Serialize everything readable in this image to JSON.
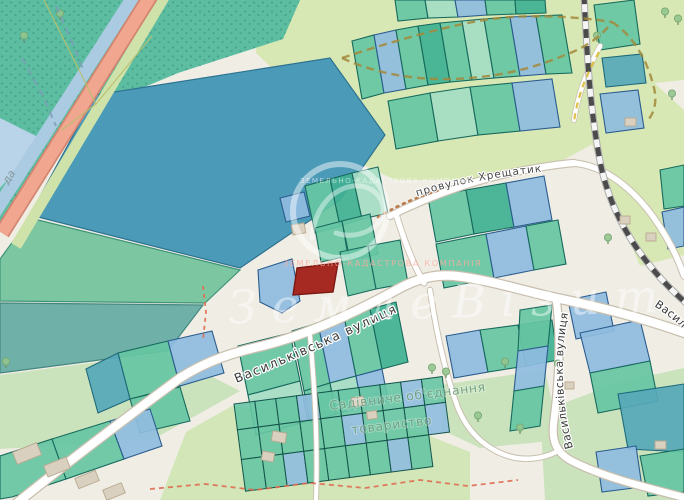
{
  "map": {
    "width": 684,
    "height": 500,
    "palette": {
      "base": "#f0ede5",
      "green_light": "#d8e8b4",
      "green_grass": "#cbe3bd",
      "green_garden": "#d2e6b8",
      "scrub": "#5dbda1",
      "scrub_dot": "#3e9a83",
      "water": "#aacbe1",
      "water_light": "#b9d4e9",
      "verge": "#cfe2a9",
      "highway": "#f1a690",
      "highway_casing": "#d28570",
      "field_blue": "#4a9ab8",
      "field_green": "#7cc6a2",
      "field_gray": "#6fb0a8",
      "parcel_teal": "#66c5a3",
      "parcel_teal_dark": "#3fb192",
      "parcel_teal_pale": "#a4dcc3",
      "parcel_blue": "#8fbcdf",
      "parcel_blue_steel": "#5e9fca",
      "parcel_blue_teal": "#57a8ba",
      "stroke_teal": "#17695c",
      "stroke_blue": "#2b5c8e",
      "stroke_blue_teal": "#1f6a7a",
      "target_red": "#a62a21",
      "target_red_stroke": "#7c1a14",
      "road_casing": "#c8bfae",
      "road_fill": "#ffffff",
      "rail_dark": "#4b4b4b",
      "building": "#d9d0c0",
      "building_stroke": "#b9a98f"
    },
    "labels": {
      "street_main": "Васильківська вулиця",
      "street_south": "Васильківська вулиця",
      "street_east_partial": "Васил",
      "lane": "провулок Хрещатик",
      "garden_assoc_line1": "Садівниче об'єднання",
      "garden_assoc_line2": "товариство",
      "water_partial": "да"
    },
    "watermark": {
      "script": "ЗемлеВізит",
      "caps": "ЗЕМЕЛЬНО-КАДАСТРОВА КОМПАНІЯ",
      "ring": {
        "cx": 340,
        "cy": 211,
        "r": 47,
        "w": 6
      },
      "swirl": "M 312,238 C 316,186 366,172 381,200 C 392,222 362,242 336,233",
      "script_x": 228,
      "script_y": 318,
      "script_len": 430,
      "caps_mid": {
        "x": 283,
        "y": 266
      },
      "caps_top": {
        "x": 300,
        "y": 183
      }
    },
    "areas": [
      {
        "p": "258,0 684,0 684,80 560,93 430,109 330,123 256,53",
        "f": "green_light"
      },
      {
        "p": "572,80 640,70 684,110 684,255 640,266 600,170",
        "f": "green_light"
      },
      {
        "p": "310,103 555,24 618,19 658,90 600,140 545,170 470,180 395,180 333,150",
        "f": "green_light"
      },
      {
        "p": "0,0 148,0 4,232 0,232",
        "f": "scrub",
        "pat": true
      },
      {
        "p": "62,0 300,0 283,39 178,73 92,109 40,79",
        "f": "scrub",
        "pat": true
      },
      {
        "p": "0,118 44,140 0,188",
        "f": "water_light"
      },
      {
        "p": "95,95 330,58 385,135 340,200 240,268 30,215",
        "f": "field_blue",
        "s": "#2e7290"
      },
      {
        "p": "30,218 240,270 205,303 0,301 0,259",
        "f": "field_green",
        "s": "#3f9478"
      },
      {
        "p": "0,303 203,305 168,351 0,373",
        "f": "field_gray",
        "s": "#43897f"
      },
      {
        "p": "0,375 166,353 240,391 150,441 0,449",
        "f": "green_grass"
      },
      {
        "p": "440,385 545,370 560,440 480,448 442,430",
        "f": "green_grass"
      },
      {
        "p": "540,412 620,382 684,368 684,500 545,500",
        "f": "green_grass"
      },
      {
        "p": "160,500 186,432 232,406 420,432 470,452 470,500",
        "f": "green_garden"
      }
    ],
    "bands": [
      {
        "d": "M 166,-6 L 16,246",
        "s": "#cfe2a9",
        "w": 11
      },
      {
        "d": "M 135,-6 L -14,226",
        "s": "#aacbe1",
        "w": 13
      },
      {
        "d": "M 153,-8 L 2,233",
        "s": "#d28570",
        "w": 16
      },
      {
        "d": "M 153,-8 L 2,233",
        "s": "#f1a690",
        "w": 12.5
      }
    ],
    "railway": {
      "d": "M 584,-5 C 587,55 590,112 601,166 C 613,222 646,268 686,303"
    },
    "roads": [
      {
        "d": "M 12,507 C 60,468 130,415 180,378 C 208,360 235,352 262,346 C 310,334 356,312 398,289 C 418,278 436,274 456,276 C 490,280 520,290 556,298 C 600,307 636,316 688,334",
        "cw": 11,
        "fw": 8.5
      },
      {
        "d": "M 556,298 C 562,340 558,390 554,420 C 551,440 556,452 570,460 C 600,476 640,486 690,499",
        "cw": 9.5,
        "fw": 7
      },
      {
        "d": "M 390,216 C 430,196 470,182 510,173 C 540,167 560,164 574,163",
        "cw": 8.5,
        "fw": 6.2
      },
      {
        "d": "M 574,163 C 606,166 634,190 654,218 C 668,238 678,258 684,276",
        "cw": 7.5,
        "fw": 5.5
      },
      {
        "d": "M 396,214 C 404,240 412,262 424,283",
        "cw": 7,
        "fw": 5.2
      },
      {
        "d": "M 310,336 C 315,390 318,445 316,500",
        "cw": 6,
        "fw": 4.2
      },
      {
        "d": "M 430,290 C 436,330 444,370 458,408 C 468,432 484,448 508,456 C 524,461 542,459 556,452",
        "cw": 6.5,
        "fw": 4.6
      },
      {
        "d": "M 600,46 C 588,68 578,94 574,120",
        "cw": 6,
        "fw": 4.5
      }
    ],
    "parcels": [
      {
        "p": "395,0 425,0 428,18 398,21",
        "c": "t"
      },
      {
        "p": "425,0 455,0 458,17 428,18",
        "c": "tl"
      },
      {
        "p": "455,0 485,0 487,15 458,17",
        "c": "b"
      },
      {
        "p": "485,0 515,0 516,14 487,15",
        "c": "t"
      },
      {
        "p": "515,0 545,0 546,13 516,14",
        "c": "td"
      },
      {
        "p": "352,41 374,35 384,93 362,99",
        "c": "t"
      },
      {
        "p": "374,35 396,30 406,89 384,93",
        "c": "b"
      },
      {
        "p": "396,30 418,26 428,85 406,89",
        "c": "t"
      },
      {
        "p": "418,26 440,23 450,82 428,85",
        "c": "td"
      },
      {
        "p": "440,23 462,21 472,80 450,82",
        "c": "t"
      },
      {
        "p": "462,21 484,19 494,78 472,80",
        "c": "tl"
      },
      {
        "p": "484,19 510,17 520,76 494,78",
        "c": "t"
      },
      {
        "p": "510,17 536,16 546,74 520,76",
        "c": "b"
      },
      {
        "p": "536,16 562,15 572,73 546,74",
        "c": "t"
      },
      {
        "p": "388,101 430,93 438,141 396,149",
        "c": "t"
      },
      {
        "p": "430,93 470,87 478,135 438,141",
        "c": "tl"
      },
      {
        "p": "470,87 512,83 520,131 478,135",
        "c": "t"
      },
      {
        "p": "512,83 552,79 560,127 520,131",
        "c": "b"
      },
      {
        "p": "594,5 634,0 640,44 600,50",
        "c": "t"
      },
      {
        "p": "602,58 642,54 646,83 606,87",
        "c": "bt"
      },
      {
        "p": "600,94 638,90 644,128 606,133",
        "c": "b"
      },
      {
        "p": "660,170 684,165 684,206 664,209",
        "c": "t"
      },
      {
        "p": "662,212 684,207 684,246 668,249",
        "c": "b"
      },
      {
        "p": "280,198 304,192 310,216 286,222",
        "c": "b"
      },
      {
        "p": "305,186 330,179 340,226 315,233",
        "c": "t"
      },
      {
        "p": "330,179 352,173 362,219 340,226",
        "c": "td"
      },
      {
        "p": "352,173 378,167 388,213 362,219",
        "c": "tl"
      },
      {
        "p": "315,228 342,221 348,256 321,262",
        "c": "t"
      },
      {
        "p": "342,221 370,214 378,254 350,260",
        "c": "t"
      },
      {
        "p": "258,270 292,259 300,301 282,313 260,302",
        "c": "b"
      },
      {
        "p": "340,252 368,246 376,289 348,296",
        "c": "t"
      },
      {
        "p": "368,246 400,240 408,283 376,289",
        "c": "t"
      },
      {
        "p": "428,198 466,190 474,234 436,242",
        "c": "t"
      },
      {
        "p": "466,190 506,183 514,227 474,234",
        "c": "td"
      },
      {
        "p": "506,183 544,176 552,220 514,227",
        "c": "b"
      },
      {
        "p": "436,244 486,234 494,278 444,288",
        "c": "t"
      },
      {
        "p": "486,234 526,226 534,270 494,278",
        "c": "b"
      },
      {
        "p": "526,226 558,220 566,264 534,270",
        "c": "t"
      },
      {
        "p": "446,336 480,330 488,372 454,378",
        "c": "b"
      },
      {
        "p": "480,330 518,325 526,366 488,372",
        "c": "t"
      },
      {
        "p": "518,325 552,320 558,360 526,366",
        "c": "td"
      },
      {
        "p": "520,310 552,305 548,346 518,351",
        "c": "t"
      },
      {
        "p": "518,351 548,346 544,386 514,391",
        "c": "b"
      },
      {
        "p": "514,391 544,386 540,426 510,431",
        "c": "t"
      },
      {
        "p": "568,300 606,292 614,331 576,339",
        "c": "b"
      },
      {
        "p": "580,333 640,320 650,361 590,373",
        "c": "b"
      },
      {
        "p": "590,373 650,361 658,401 598,413",
        "c": "t"
      },
      {
        "p": "618,394 684,384 684,452 628,449",
        "c": "bt"
      },
      {
        "p": "640,456 684,449 684,492 648,496",
        "c": "t"
      },
      {
        "p": "596,452 636,446 642,487 602,492",
        "c": "b"
      },
      {
        "p": "292,331 318,323 330,383 304,391",
        "c": "t"
      },
      {
        "p": "318,323 344,316 356,376 330,383",
        "c": "b"
      },
      {
        "p": "344,316 370,309 382,369 356,376",
        "c": "t"
      },
      {
        "p": "370,309 396,302 408,362 382,369",
        "c": "td"
      },
      {
        "p": "304,391 330,383 336,414 310,422",
        "c": "t"
      },
      {
        "p": "330,383 356,376 362,407 336,414",
        "c": "tl"
      },
      {
        "p": "356,376 382,369 388,400 362,407",
        "c": "b"
      },
      {
        "p": "238,346 290,333 300,381 248,395",
        "c": "t"
      },
      {
        "p": "248,395 300,381 308,421 256,435",
        "c": "tl"
      },
      {
        "p": "118,353 168,341 180,386 130,399",
        "c": "t"
      },
      {
        "p": "168,341 212,331 224,373 180,386",
        "c": "b"
      },
      {
        "p": "130,399 180,387 190,421 140,433",
        "c": "t"
      },
      {
        "p": "86,369 118,353 130,399 98,413",
        "c": "bt"
      },
      {
        "p": "0,456 52,439 66,479 12,497 0,499",
        "c": "t"
      },
      {
        "p": "52,439 110,421 124,459 66,479",
        "c": "t"
      },
      {
        "p": "110,421 150,409 162,446 124,459",
        "c": "b"
      }
    ],
    "target_parcel": {
      "p": "297,268 338,263 333,292 293,295"
    },
    "garden_grid": {
      "x": 234,
      "y": 404,
      "rot": -7.5,
      "cw": 21,
      "rows": [
        {
          "h": 26,
          "n": 10
        },
        {
          "h": 30,
          "n": 10
        },
        {
          "h": 32,
          "n": 9
        }
      ],
      "blue": [
        [
          0,
          3
        ],
        [
          0,
          8
        ],
        [
          1,
          5
        ],
        [
          1,
          9
        ],
        [
          2,
          2
        ],
        [
          2,
          7
        ]
      ]
    },
    "buildings": [
      [
        14,
        447,
        26,
        13,
        -22
      ],
      [
        45,
        461,
        24,
        12,
        -22
      ],
      [
        76,
        474,
        22,
        11,
        -22
      ],
      [
        104,
        486,
        20,
        11,
        -22
      ],
      [
        292,
        224,
        13,
        10,
        -10
      ],
      [
        272,
        432,
        14,
        10,
        10
      ],
      [
        262,
        452,
        12,
        9,
        10
      ],
      [
        352,
        397,
        12,
        9,
        -8
      ],
      [
        367,
        411,
        10,
        8,
        -8
      ],
      [
        625,
        118,
        11,
        8,
        0
      ],
      [
        620,
        216,
        10,
        8,
        0
      ],
      [
        646,
        233,
        10,
        8,
        0
      ],
      [
        565,
        382,
        9,
        7,
        0
      ],
      [
        655,
        441,
        11,
        8,
        0
      ]
    ],
    "trees": [
      [
        597,
        38
      ],
      [
        608,
        240
      ],
      [
        432,
        370
      ],
      [
        446,
        374
      ],
      [
        558,
        366
      ],
      [
        520,
        430
      ],
      [
        478,
        418
      ],
      [
        665,
        14
      ],
      [
        678,
        21
      ],
      [
        60,
        16
      ],
      [
        24,
        38
      ],
      [
        6,
        364
      ],
      [
        505,
        364
      ],
      [
        672,
        96
      ]
    ],
    "decor": [
      {
        "d": "M 342,58 C 390,42 440,28 478,21 C 510,15 560,14 612,22",
        "s": "#a38a3c",
        "w": 2.4,
        "dash": "8 5",
        "o": 0.85
      },
      {
        "d": "M 342,58 C 372,72 410,80 450,79 C 492,78 530,70 565,55 C 585,48 602,36 612,22",
        "s": "#a38a3c",
        "w": 2.4,
        "dash": "8 5",
        "o": 0.85
      },
      {
        "d": "M 612,22 C 634,36 648,62 654,88 C 657,100 655,112 648,120",
        "s": "#a38a3c",
        "w": 2.4,
        "dash": "8 5",
        "o": 0.85
      },
      {
        "d": "M 599,52 C 586,75 577,98 574,122",
        "s": "#d9ba35",
        "w": 2.2,
        "dash": "6 5",
        "o": 0.9
      },
      {
        "d": "M 150,489 L 205,484 L 255,490 L 310,483 L 365,488 L 420,480 L 468,486 L 518,480",
        "s": "#e06b52",
        "w": 1.8,
        "dash": "5 4",
        "o": 0.9
      },
      {
        "d": "M 203,286 L 206,312 L 203,340",
        "s": "#e06b52",
        "w": 1.8,
        "dash": "4 4",
        "o": 0.9
      },
      {
        "d": "M 56,6 L 72,42 L 84,72",
        "s": "#7b9fb6",
        "w": 2.2,
        "dash": "7 5",
        "o": 0.8
      },
      {
        "d": "M 22,58 L 42,94 L 56,126",
        "s": "#7b9fb6",
        "w": 2.2,
        "dash": "7 5",
        "o": 0.8
      },
      {
        "d": "M 44,0 L 96,104 L 62,130",
        "s": "#b9bf6d",
        "w": 1.2,
        "o": 0.9
      },
      {
        "d": "M 152,36 L 96,104",
        "s": "#b9bf6d",
        "w": 1.2,
        "o": 0.9
      },
      {
        "d": "M 378,217 C 400,204 420,196 440,190",
        "s": "#b5703d",
        "w": 2.6,
        "dash": "2 5",
        "o": 0.9,
        "cap": "round"
      }
    ],
    "label_paths": {
      "main": "M 234,384 C 300,358 360,330 422,300 C 436,293 448,289 460,287",
      "south": "M 573,448 C 561,404 560,355 568,314",
      "east": "M 654,306 C 668,315 680,325 690,336",
      "lane": "M 404,201 C 448,185 505,174 572,169"
    },
    "garden_label_pos": {
      "x1": 330,
      "y1": 410,
      "x2": 352,
      "y2": 434,
      "rot": -7
    },
    "water_label_pos": {
      "x": 8,
      "y": 185,
      "rot": -57
    }
  }
}
